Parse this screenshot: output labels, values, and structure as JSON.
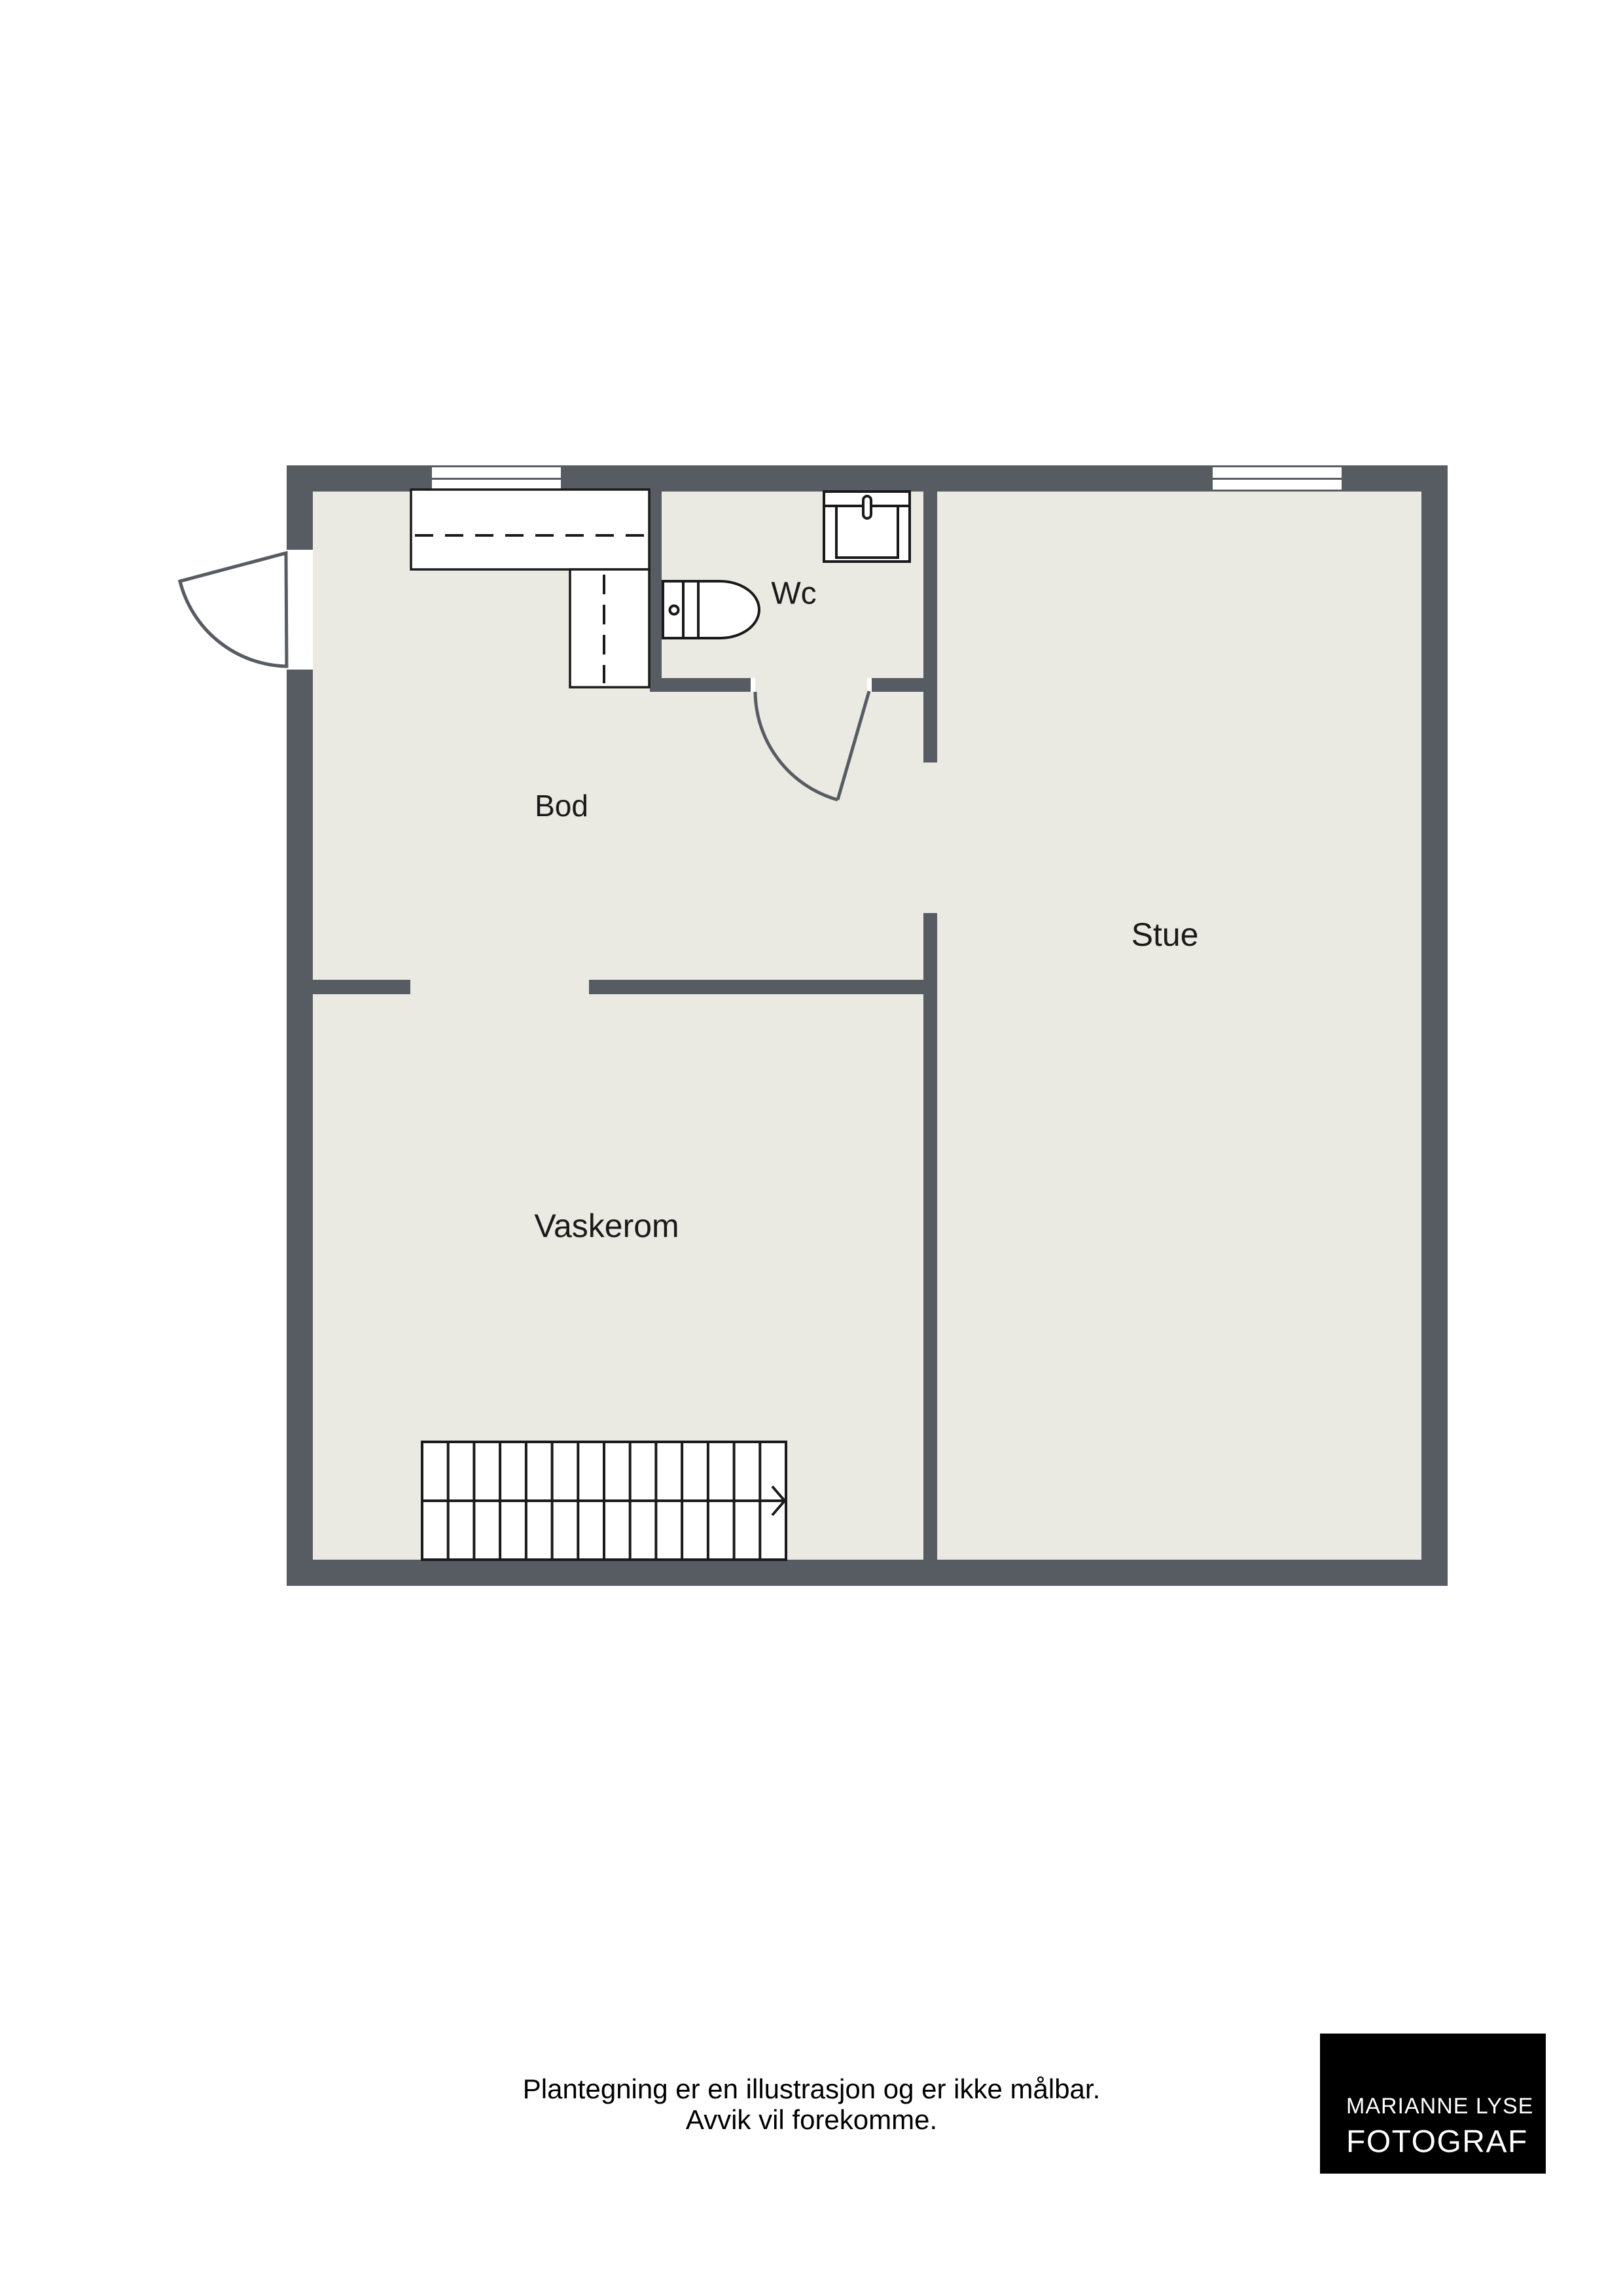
{
  "rooms": {
    "bod": {
      "label": "Bod"
    },
    "wc": {
      "label": "Wc"
    },
    "stue": {
      "label": "Stue"
    },
    "vaskerom": {
      "label": "Vaskerom"
    }
  },
  "disclaimer": {
    "line1": "Plantegning er en illustrasjon og er ikke målbar.",
    "line2": "Avvik vil forekomme."
  },
  "logo": {
    "name": "MARIANNE LYSE",
    "title": "FOTOGRAF"
  },
  "fixtures": [
    "wardrobe-icon",
    "cabinet-icon",
    "toilet-icon",
    "sink-icon",
    "staircase-icon",
    "stair-direction-arrow-icon",
    "entry-door-icon",
    "wc-door-icon",
    "window-icon"
  ],
  "colors": {
    "wall": "#575C63",
    "floor": "#EAEAE2",
    "line": "#1A1A1A",
    "page": "#FFFFFF",
    "logo_bg": "#000000",
    "logo_text": "#FFFFFF"
  }
}
